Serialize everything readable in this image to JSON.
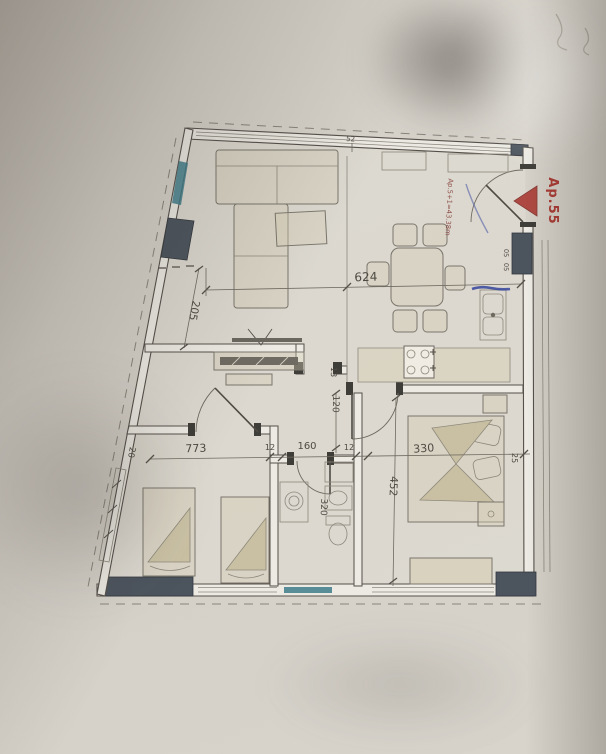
{
  "colors": {
    "paper": "#d6d2ca",
    "line": "#55504a",
    "line-light": "#8d887e",
    "wall-fill": "#eceae3",
    "pillar": "#4c545e",
    "window-teal": "#3e7d8b",
    "red": "#a93a33",
    "pen-blue": "#35459c",
    "dim-text": "#4e4a43"
  },
  "annotations": {
    "apartment_id": "Ap.55",
    "area_note": "Ap.5+1=43.38m"
  },
  "dimensions": {
    "top_width": "624",
    "top_small": "52",
    "left_wall": "205",
    "left_small": "20",
    "hall_wall": "13",
    "hall_corridor": "120",
    "room1_width": "773",
    "wall_a": "12",
    "bath_width": "160",
    "wall_b": "12",
    "bed2_width": "330",
    "bed2_depth": "452",
    "bath_depth": "320",
    "right_small": "25",
    "wall_small": "05"
  }
}
